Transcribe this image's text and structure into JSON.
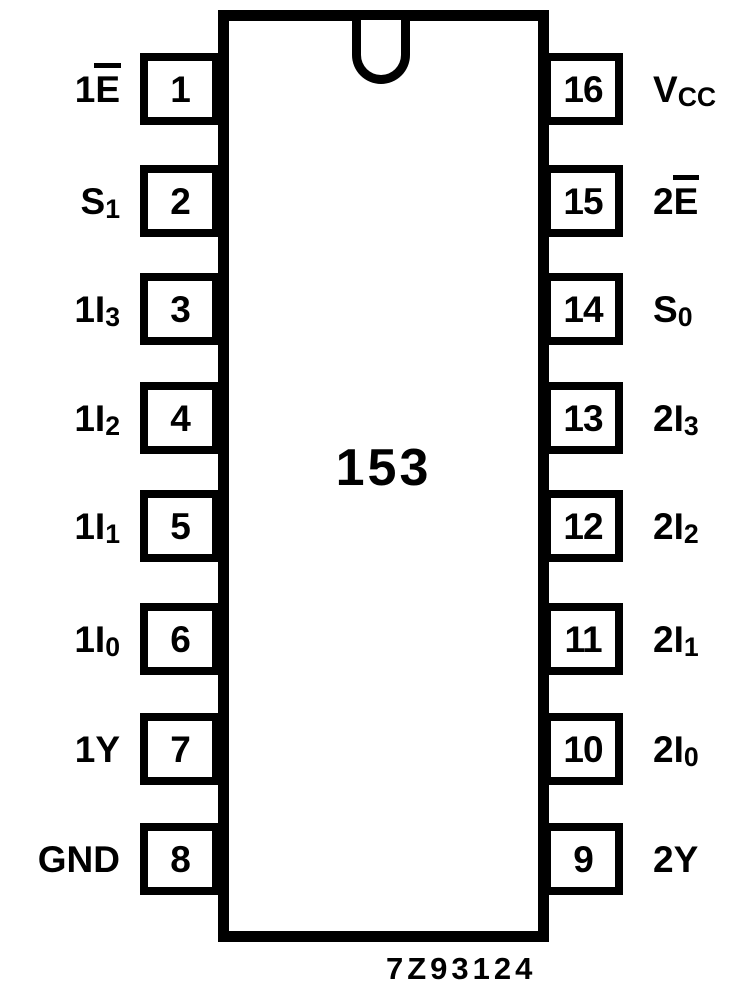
{
  "colors": {
    "ink": "#000000",
    "background": "#ffffff"
  },
  "chip": {
    "part_number": "153",
    "drawing_code": "7Z93124"
  },
  "pins": {
    "left": [
      {
        "number": "1",
        "label": {
          "pre": "1",
          "main": "E",
          "sub": "",
          "overline": true
        }
      },
      {
        "number": "2",
        "label": {
          "pre": "",
          "main": "S",
          "sub": "1",
          "overline": false
        }
      },
      {
        "number": "3",
        "label": {
          "pre": "1",
          "main": "I",
          "sub": "3",
          "overline": false
        }
      },
      {
        "number": "4",
        "label": {
          "pre": "1",
          "main": "I",
          "sub": "2",
          "overline": false
        }
      },
      {
        "number": "5",
        "label": {
          "pre": "1",
          "main": "I",
          "sub": "1",
          "overline": false
        }
      },
      {
        "number": "6",
        "label": {
          "pre": "1",
          "main": "I",
          "sub": "0",
          "overline": false
        }
      },
      {
        "number": "7",
        "label": {
          "pre": "1",
          "main": "Y",
          "sub": "",
          "overline": false
        }
      },
      {
        "number": "8",
        "label": {
          "pre": "",
          "main": "GND",
          "sub": "",
          "overline": false
        }
      }
    ],
    "right": [
      {
        "number": "16",
        "label": {
          "pre": "",
          "main": "V",
          "sub": "CC",
          "overline": false
        }
      },
      {
        "number": "15",
        "label": {
          "pre": "2",
          "main": "E",
          "sub": "",
          "overline": true
        }
      },
      {
        "number": "14",
        "label": {
          "pre": "",
          "main": "S",
          "sub": "0",
          "overline": false
        }
      },
      {
        "number": "13",
        "label": {
          "pre": "2",
          "main": "I",
          "sub": "3",
          "overline": false
        }
      },
      {
        "number": "12",
        "label": {
          "pre": "2",
          "main": "I",
          "sub": "2",
          "overline": false
        }
      },
      {
        "number": "11",
        "label": {
          "pre": "2",
          "main": "I",
          "sub": "1",
          "overline": false
        }
      },
      {
        "number": "10",
        "label": {
          "pre": "2",
          "main": "I",
          "sub": "0",
          "overline": false
        }
      },
      {
        "number": "9",
        "label": {
          "pre": "2",
          "main": "Y",
          "sub": "",
          "overline": false
        }
      }
    ]
  }
}
